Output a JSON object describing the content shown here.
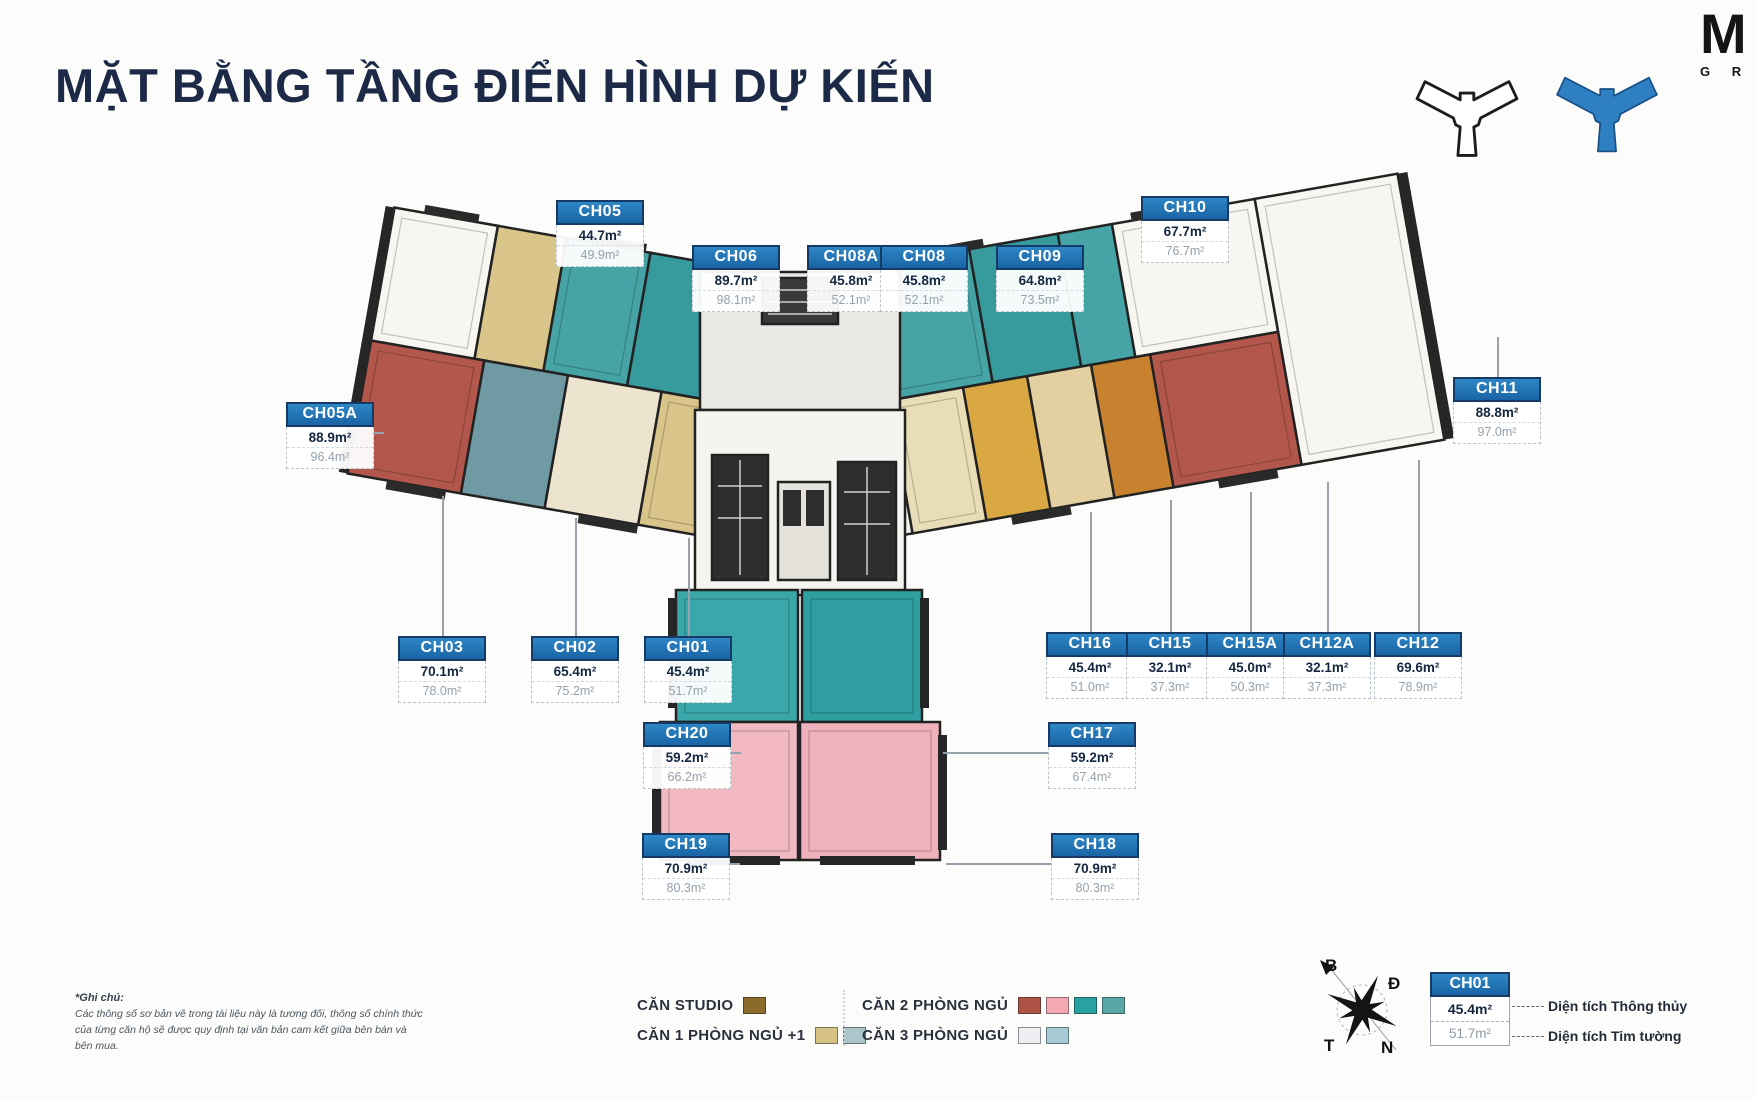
{
  "title": "MẶT BẰNG TẦNG ĐIỂN HÌNH DỰ KIẾN",
  "brand": {
    "letter": "M",
    "subtext": "G R"
  },
  "units": [
    {
      "id": "CH05",
      "area_net": "44.7m²",
      "area_gross": "49.9m²",
      "x": 600,
      "y": 200,
      "leader": {
        "dir": "down",
        "len": 8
      }
    },
    {
      "id": "CH06",
      "area_net": "89.7m²",
      "area_gross": "98.1m²",
      "x": 736,
      "y": 245,
      "leader": {
        "dir": "down",
        "len": 6
      }
    },
    {
      "id": "CH08A",
      "area_net": "45.8m²",
      "area_gross": "52.1m²",
      "x": 851,
      "y": 245,
      "leader": {
        "dir": "down",
        "len": 6
      }
    },
    {
      "id": "CH08",
      "area_net": "45.8m²",
      "area_gross": "52.1m²",
      "x": 924,
      "y": 245,
      "leader": {
        "dir": "down",
        "len": 6
      }
    },
    {
      "id": "CH09",
      "area_net": "64.8m²",
      "area_gross": "73.5m²",
      "x": 1040,
      "y": 245,
      "leader": {
        "dir": "down",
        "len": 6
      }
    },
    {
      "id": "CH10",
      "area_net": "67.7m²",
      "area_gross": "76.7m²",
      "x": 1185,
      "y": 196,
      "leader": {
        "dir": "down",
        "len": 8
      }
    },
    {
      "id": "CH11",
      "area_net": "88.8m²",
      "area_gross": "97.0m²",
      "x": 1497,
      "y": 377,
      "leader": {
        "dir": "up",
        "len": 40
      }
    },
    {
      "id": "CH05A",
      "area_net": "88.9m²",
      "area_gross": "96.4m²",
      "x": 330,
      "y": 402,
      "leader": {
        "dir": "right",
        "len": 10
      }
    },
    {
      "id": "CH03",
      "area_net": "70.1m²",
      "area_gross": "78.0m²",
      "x": 442,
      "y": 636,
      "leader": {
        "dir": "up",
        "len": 140
      }
    },
    {
      "id": "CH02",
      "area_net": "65.4m²",
      "area_gross": "75.2m²",
      "x": 575,
      "y": 636,
      "leader": {
        "dir": "up",
        "len": 118
      }
    },
    {
      "id": "CH01",
      "area_net": "45.4m²",
      "area_gross": "51.7m²",
      "x": 688,
      "y": 636,
      "leader": {
        "dir": "up",
        "len": 98
      }
    },
    {
      "id": "CH16",
      "area_net": "45.4m²",
      "area_gross": "51.0m²",
      "x": 1090,
      "y": 632,
      "leader": {
        "dir": "up",
        "len": 120
      }
    },
    {
      "id": "CH15",
      "area_net": "32.1m²",
      "area_gross": "37.3m²",
      "x": 1170,
      "y": 632,
      "leader": {
        "dir": "up",
        "len": 132
      }
    },
    {
      "id": "CH15A",
      "area_net": "45.0m²",
      "area_gross": "50.3m²",
      "x": 1250,
      "y": 632,
      "leader": {
        "dir": "up",
        "len": 140
      }
    },
    {
      "id": "CH12A",
      "area_net": "32.1m²",
      "area_gross": "37.3m²",
      "x": 1327,
      "y": 632,
      "leader": {
        "dir": "up",
        "len": 150
      }
    },
    {
      "id": "CH12",
      "area_net": "69.6m²",
      "area_gross": "78.9m²",
      "x": 1418,
      "y": 632,
      "leader": {
        "dir": "up",
        "len": 172
      }
    },
    {
      "id": "CH20",
      "area_net": "59.2m²",
      "area_gross": "66.2m²",
      "x": 687,
      "y": 722,
      "leader": {
        "dir": "right",
        "len": 10
      }
    },
    {
      "id": "CH17",
      "area_net": "59.2m²",
      "area_gross": "67.4m²",
      "x": 1092,
      "y": 722,
      "leader": {
        "dir": "left",
        "len": 105
      }
    },
    {
      "id": "CH19",
      "area_net": "70.9m²",
      "area_gross": "80.3m²",
      "x": 686,
      "y": 833,
      "leader": {
        "dir": "right",
        "len": 10
      }
    },
    {
      "id": "CH18",
      "area_net": "70.9m²",
      "area_gross": "80.3m²",
      "x": 1095,
      "y": 833,
      "leader": {
        "dir": "left",
        "len": 105
      }
    }
  ],
  "legend": {
    "items": [
      {
        "label": "CĂN STUDIO",
        "colors": [
          "#8a6b2b"
        ]
      },
      {
        "label": "CĂN 1 PHÒNG NGỦ +1",
        "colors": [
          "#d6c285",
          "#aac6cb"
        ]
      },
      {
        "label": "CĂN 2 PHÒNG NGỦ",
        "colors": [
          "#ae5245",
          "#f2a9b0",
          "#28a2a1",
          "#5aa8a6"
        ]
      },
      {
        "label": "CĂN 3 PHÒNG NGỦ",
        "colors": [
          "#edeff2",
          "#a5cad3"
        ]
      }
    ]
  },
  "compass": {
    "north": "B",
    "east": "Đ",
    "west": "T",
    "south": "N"
  },
  "area_key": {
    "id": "CH01",
    "net": "45.4m²",
    "gross": "51.7m²",
    "net_label": "Diện tích Thông thủy",
    "gross_label": "Diện tích Tim tường"
  },
  "note": {
    "heading": "*Ghi chú:",
    "body": "Các thông số sơ bản vẽ trong tài liệu này là tương đối, thông số chính thức của từng căn hộ sẽ được quy định tại văn bản cam kết giữa bên bán và bên mua."
  }
}
